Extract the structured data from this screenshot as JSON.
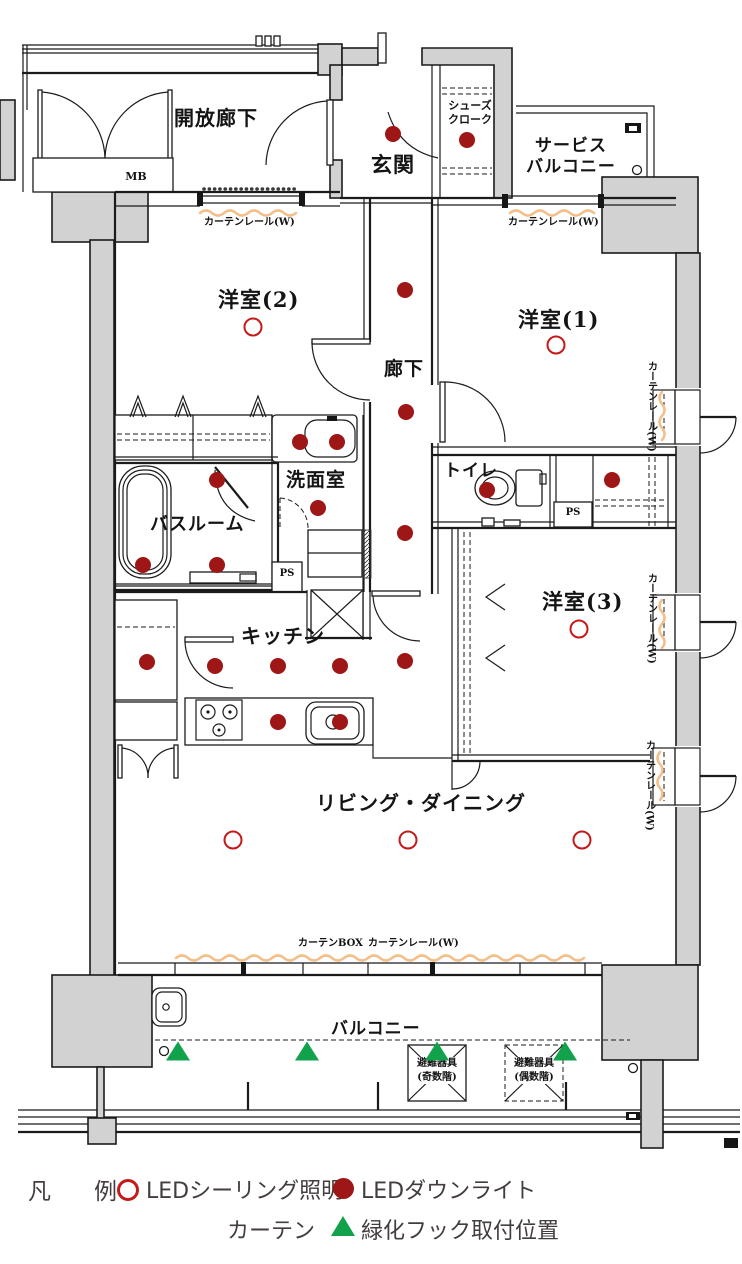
{
  "plan": {
    "rooms": {
      "open_corridor": "開放廊下",
      "mb": "MB",
      "entrance": "玄関",
      "shoe_closet": "シューズ\nクローク",
      "service_balcony": "サービス\nバルコニー",
      "western_room_2": "洋室(2)",
      "western_room_1": "洋室(1)",
      "hallway": "廊下",
      "washroom": "洗面室",
      "toilet": "トイレ",
      "bathroom": "バスルーム",
      "western_room_3": "洋室(3)",
      "kitchen": "キッチン",
      "living_dining": "リビング・ダイニング",
      "balcony": "バルコニー",
      "ps": "PS"
    },
    "annotations": {
      "curtain_rail": "カーテンレール(W)",
      "curtain_box": "カーテンBOX",
      "evac_odd": "避難器具\n(奇数階)",
      "evac_even": "避難器具\n(偶数階)"
    },
    "symbols": {
      "downlights": [
        [
          393,
          134
        ],
        [
          467,
          140
        ],
        [
          405,
          290
        ],
        [
          406,
          412
        ],
        [
          300,
          442
        ],
        [
          337,
          442
        ],
        [
          217,
          480
        ],
        [
          487,
          490
        ],
        [
          318,
          508
        ],
        [
          405,
          533
        ],
        [
          612,
          480
        ],
        [
          143,
          565
        ],
        [
          217,
          565
        ],
        [
          147,
          662
        ],
        [
          215,
          666
        ],
        [
          278,
          666
        ],
        [
          340,
          666
        ],
        [
          405,
          661
        ],
        [
          278,
          722
        ],
        [
          340,
          722
        ]
      ],
      "ceiling_lights": [
        [
          253,
          327
        ],
        [
          556,
          345
        ],
        [
          579,
          629
        ],
        [
          233,
          840
        ],
        [
          408,
          840
        ],
        [
          582,
          840
        ]
      ],
      "green_hooks": [
        [
          178,
          1051
        ],
        [
          307,
          1051
        ],
        [
          437,
          1051
        ],
        [
          565,
          1051
        ]
      ]
    }
  },
  "legend": {
    "title": "凡　例",
    "ceiling_light_label": "LEDシーリング照明",
    "downlight_label": "LEDダウンライト",
    "curtain_label": "カーテン",
    "hook_label": "緑化フック取付位置"
  },
  "colors": {
    "wall_gray": "#d2d2d2",
    "curtain_orange": "#f2c08c",
    "downlight_red": "#9e1616",
    "ceiling_light_red": "#c41a1a",
    "hook_green": "#12a24b",
    "legend_text": "#443d3d"
  }
}
